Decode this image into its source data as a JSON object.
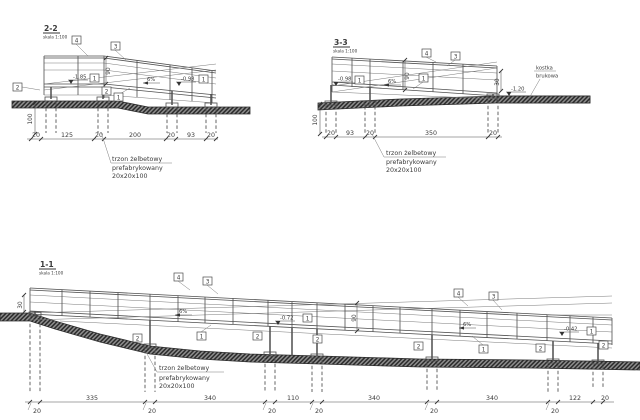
{
  "callouts": {
    "c1": "1",
    "c2": "2",
    "c3": "3",
    "c4": "4"
  },
  "note_shaft": {
    "l1": "trzon żelbetowy",
    "l2": "prefabrykowany",
    "l3": "20x20x100"
  },
  "note_paving": {
    "l1": "kostka",
    "l2": "brukowa"
  },
  "s22": {
    "title": "2-2",
    "scale": "skala 1:100",
    "elev_left": "-1.85",
    "elev_right": "-0.98",
    "slope": "6%",
    "rail_height": "90",
    "shaft_depth": "100",
    "dims": [
      "20",
      "125",
      "20",
      "200",
      "20",
      "93",
      "20"
    ]
  },
  "s33": {
    "title": "3-3",
    "scale": "skala 1:100",
    "elev_left": "-0.98",
    "elev_paving": "-1.20",
    "slope": "6%",
    "rail_height": "90",
    "end_height": "30",
    "shaft_depth": "100",
    "dims": [
      "20",
      "93",
      "20",
      "350",
      "20"
    ]
  },
  "s11": {
    "title": "1-1",
    "scale": "skala 1:100",
    "elev_mid": "-0.72",
    "elev_right": "-0.42",
    "slope": "6%",
    "rail_height": "90",
    "end_height": "30",
    "dims": [
      "335",
      "340",
      "110",
      "340",
      "340",
      "122",
      "20"
    ],
    "support_width": "20"
  }
}
